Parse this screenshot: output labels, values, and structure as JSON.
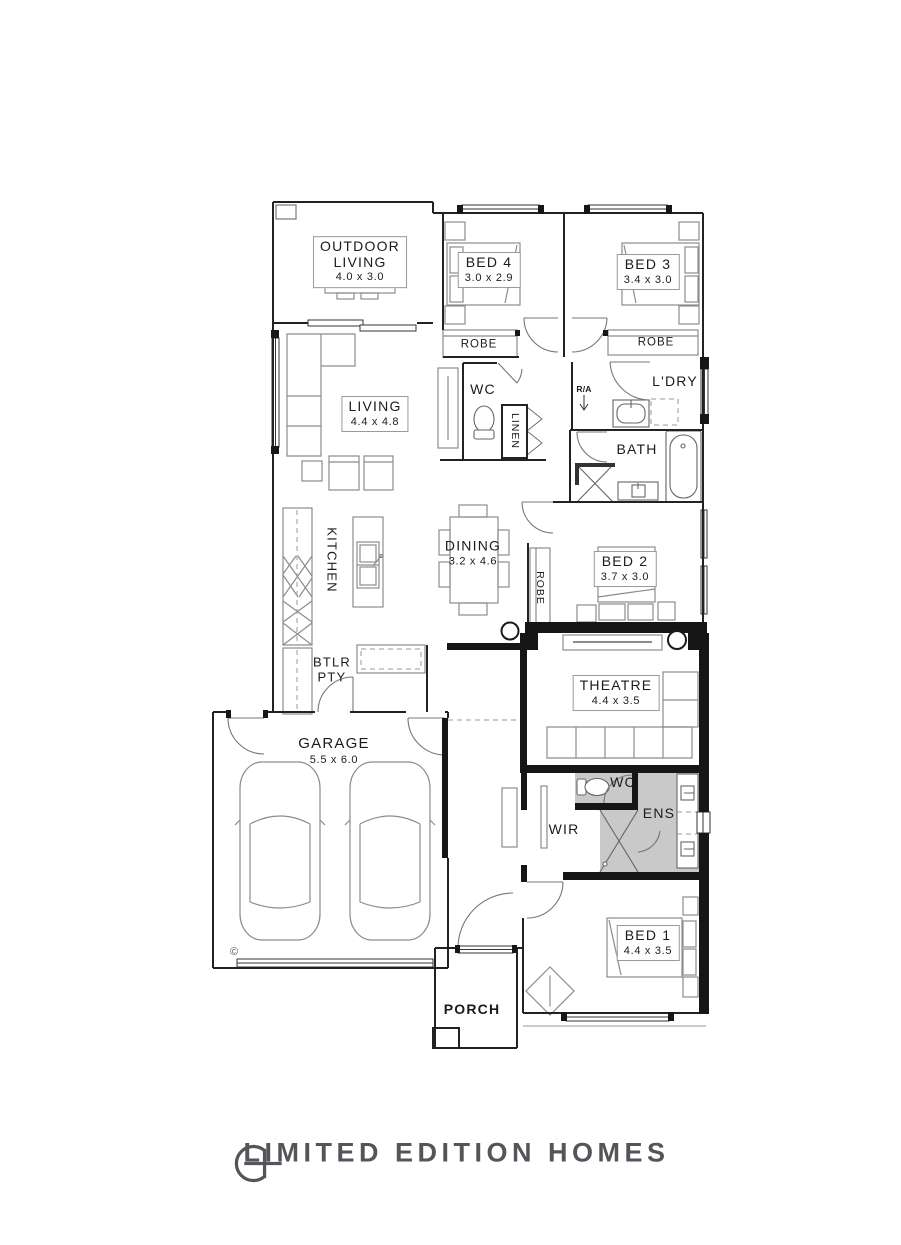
{
  "plan": {
    "rooms": {
      "outdoor_living": {
        "label_line1": "OUTDOOR",
        "label_line2": "LIVING",
        "dims": "4.0 x 3.0"
      },
      "bed4": {
        "label": "BED 4",
        "dims": "3.0 x 2.9"
      },
      "bed3": {
        "label": "BED 3",
        "dims": "3.4 x 3.0"
      },
      "living": {
        "label": "LIVING",
        "dims": "4.4 x 4.8"
      },
      "dining": {
        "label": "DINING",
        "dims": "3.2 x 4.6"
      },
      "kitchen": {
        "label": "KITCHEN"
      },
      "butlers_pantry": {
        "label_line1": "BTLR",
        "label_line2": "PTY"
      },
      "bed2": {
        "label": "BED 2",
        "dims": "3.7 x 3.0"
      },
      "theatre": {
        "label": "THEATRE",
        "dims": "4.4 x 3.5"
      },
      "garage": {
        "label": "GARAGE",
        "dims": "5.5 x 6.0"
      },
      "bed1": {
        "label": "BED 1",
        "dims": "4.4 x 3.5"
      },
      "bath": {
        "label": "BATH"
      },
      "laundry": {
        "label": "L'DRY"
      },
      "wc_front": {
        "label": "WC"
      },
      "wc_ensuite": {
        "label": "WC"
      },
      "ensuite": {
        "label": "ENS"
      },
      "wir": {
        "label": "WIR"
      },
      "linen": {
        "label": "LINEN"
      },
      "robe_bed4": {
        "label": "ROBE"
      },
      "robe_bed3": {
        "label": "ROBE"
      },
      "robe_bed2": {
        "label": "ROBE"
      },
      "porch": {
        "label": "PORCH"
      },
      "return_air": {
        "label": "R/A"
      }
    },
    "copyright_mark": "©"
  },
  "footer": {
    "brand": "LIMITED EDITION HOMES"
  },
  "colors": {
    "wall": "#1a1a1a",
    "furniture_line": "#8c8c8c",
    "wet_area_fill": "#c9c9c9",
    "logo_text": "#54555a"
  }
}
